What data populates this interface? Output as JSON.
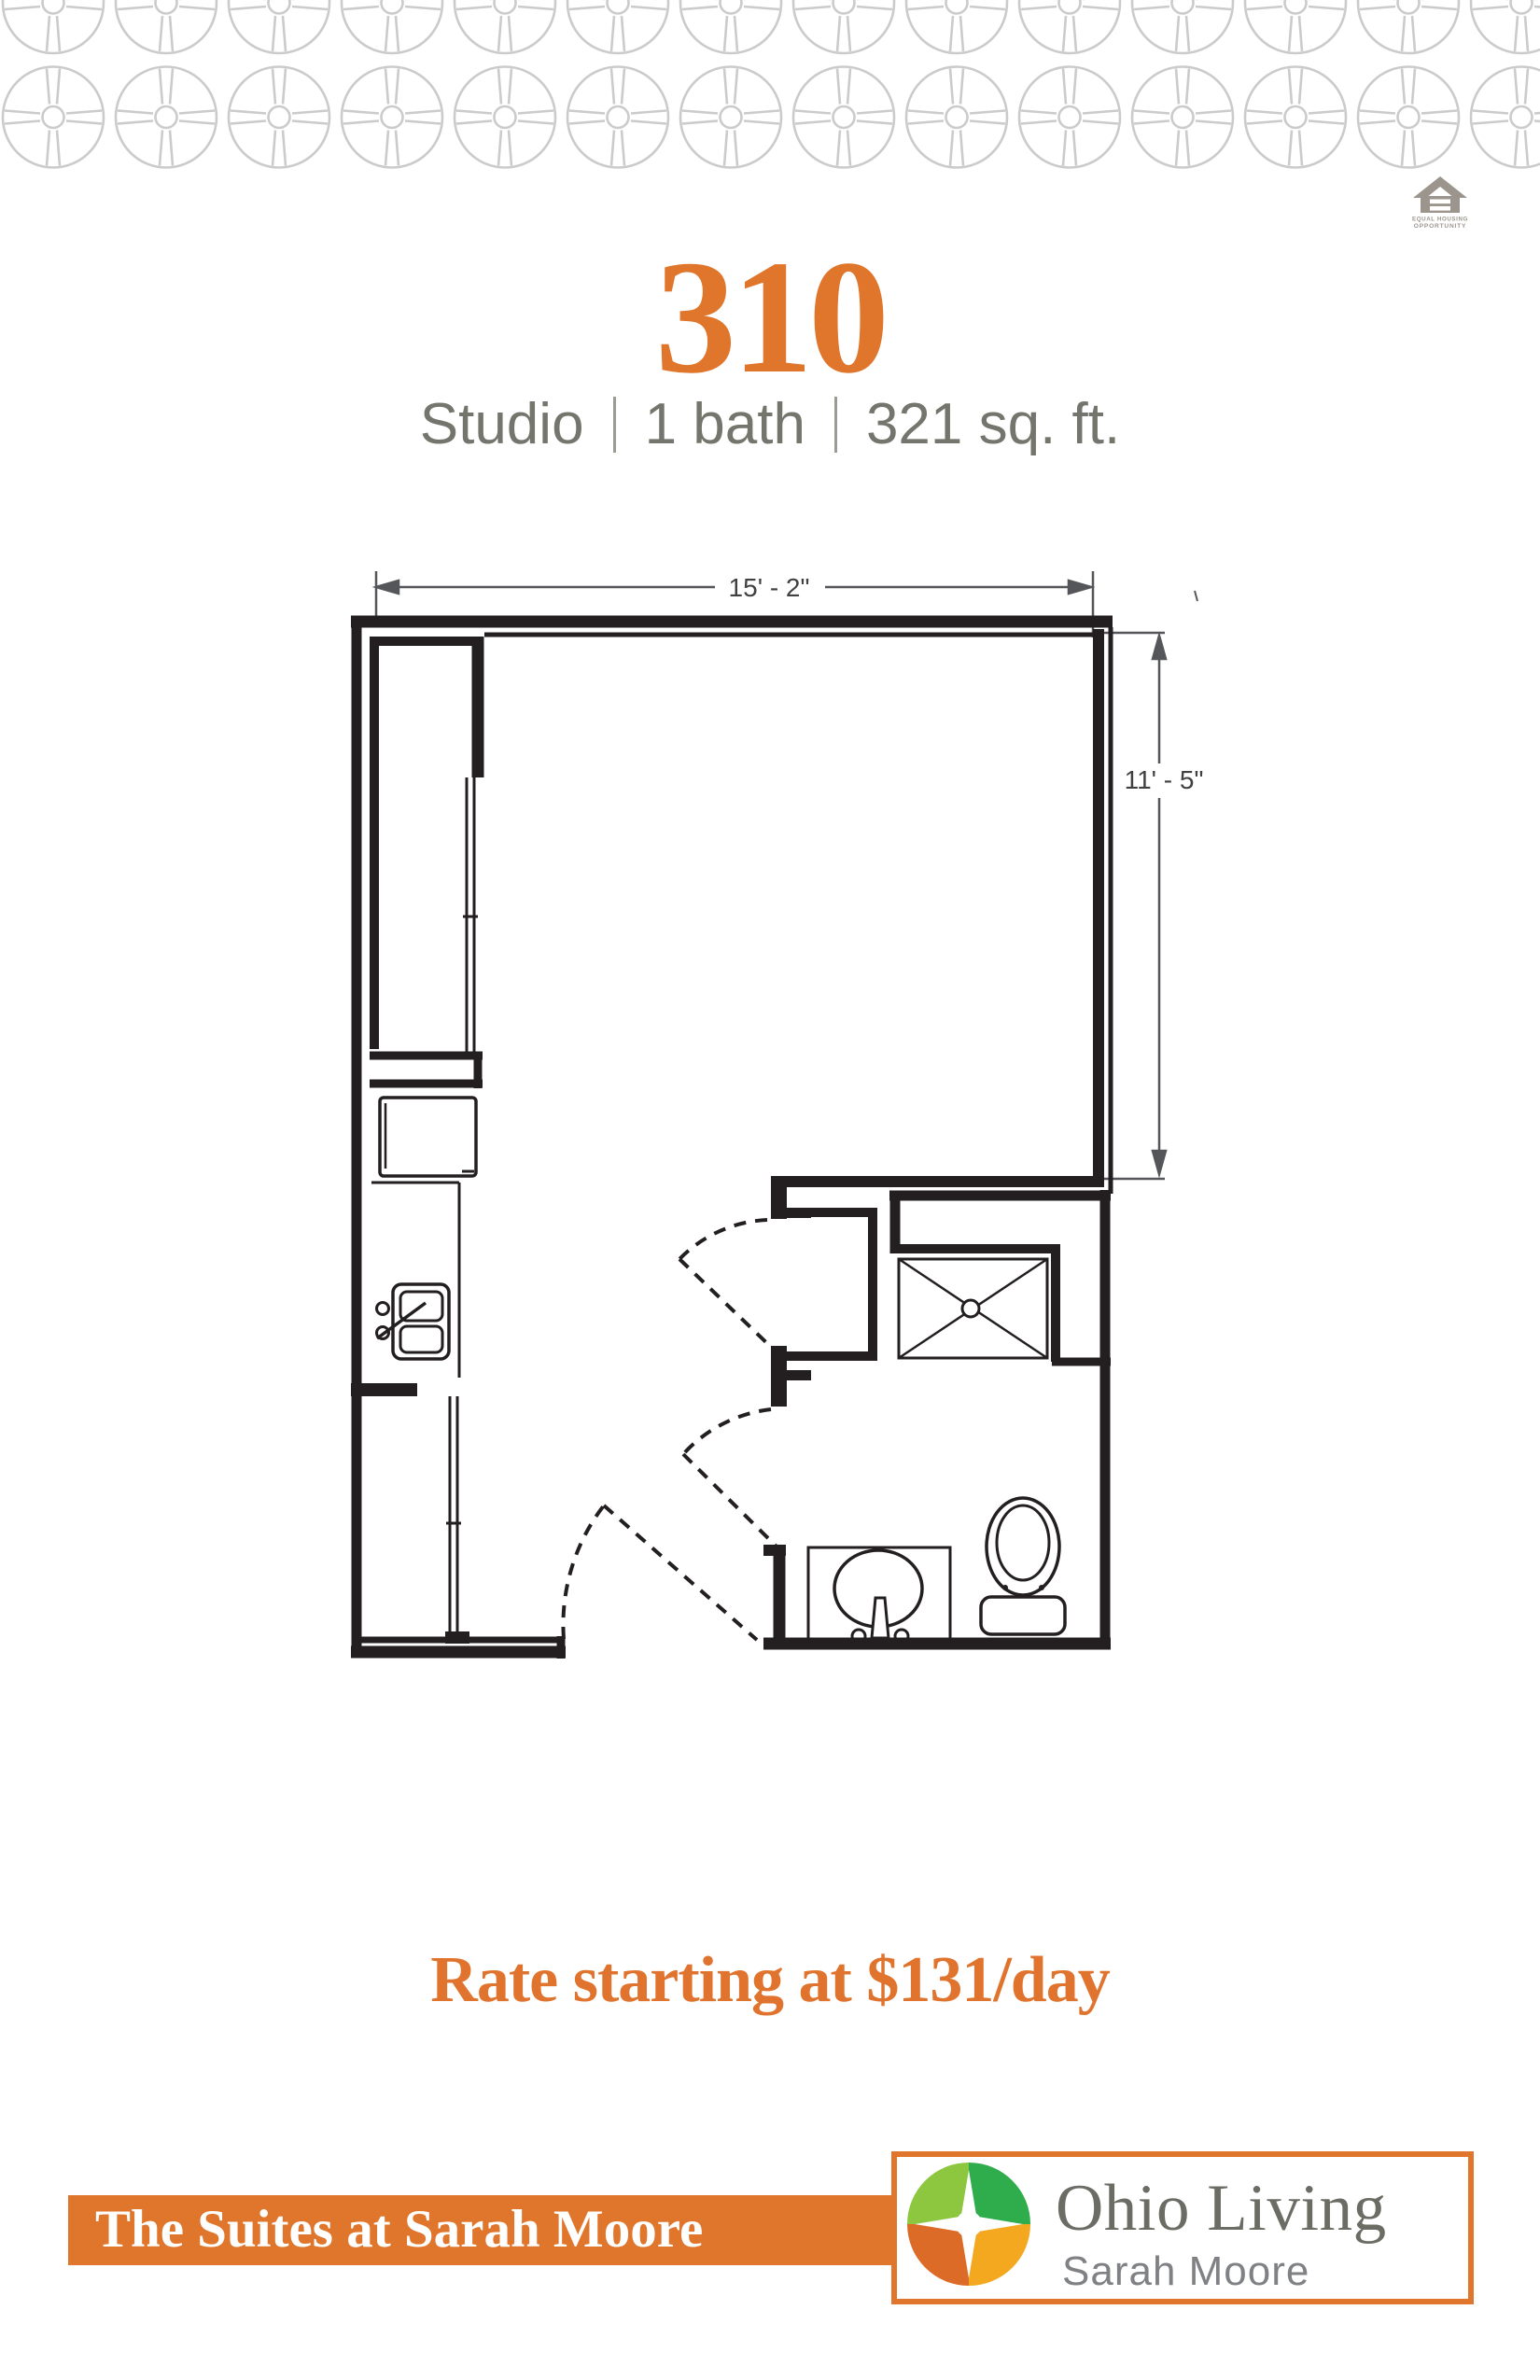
{
  "header": {
    "unit_number": "310",
    "specs": [
      "Studio",
      "1 bath",
      "321 sq. ft."
    ]
  },
  "equal_housing": {
    "line1": "EQUAL HOUSING",
    "line2": "OPPORTUNITY"
  },
  "floorplan": {
    "width_label": "15' - 2\"",
    "height_label": "11' - 5\"",
    "fixtures": [
      "refrigerator",
      "kitchen-sink",
      "counter",
      "closet-doors",
      "shower",
      "vanity-sink",
      "toilet",
      "entry-door-swing",
      "closet-door-swing",
      "bathroom-door-swing"
    ]
  },
  "rate": {
    "text": "Rate starting at $131/day"
  },
  "footer": {
    "community": "The Suites at Sarah Moore",
    "brand": "Ohio Living",
    "location": "Sarah Moore"
  },
  "colors": {
    "accent_orange": "#e0752c",
    "spec_gray": "#74766e",
    "plan_ink": "#231f20",
    "dimension_gray": "#54565a",
    "pattern_gray": "#cbcbcb",
    "eho_gray": "#9b958d",
    "brand_text": "#6b6c64",
    "brand_location_text": "#7f8184",
    "mark_green_light": "#8dc63f",
    "mark_green": "#2fac4b",
    "mark_orange": "#dd6b28",
    "mark_amber": "#f3a81f"
  }
}
